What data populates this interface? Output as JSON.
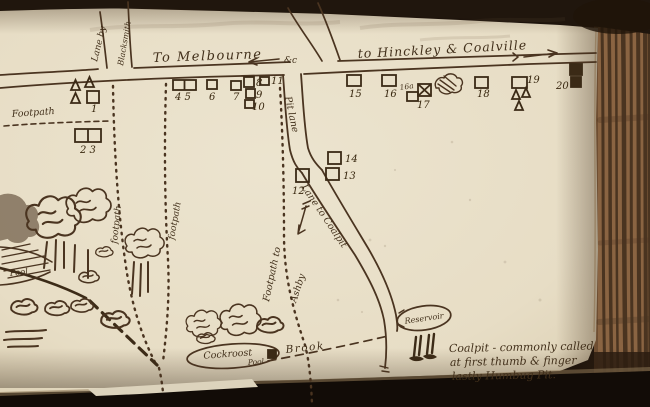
{
  "page": {
    "type": "notebook-hand-drawn-map",
    "paper_color": "#e9e0ca",
    "ink_color": "#4a3420",
    "fore_edge_color": "#8a6442"
  },
  "map": {
    "labels": {
      "to_melbourne": "To Melbourne",
      "etc_mark": "&c",
      "to_hinckley_coalville": "to Hinckley & Coalville",
      "lane_by": "Lane by",
      "blacksmith": "Blacksmith",
      "pit_lane": "Pit lane",
      "lane_to_coalpit": "Lane to Coalpit",
      "footpath_left": "Footpath",
      "footpath_1": "footpath",
      "footpath_2": "footpath",
      "footpath_to": "Footpath to",
      "ashby": "Ashby",
      "brook": "Brook",
      "pool_left": "Pool",
      "cockroost": "Cockroost",
      "cockroost_pool": "Pool",
      "reservoir": "Reservoir",
      "sixteen_a": "16a"
    },
    "note": {
      "line1": "Coalpit - commonly called",
      "line2": "at first thumb & finger",
      "line3": "lastly Humbug Pit."
    },
    "houses": [
      {
        "label": "4 5",
        "kind": "pair",
        "x": 173,
        "y": 80,
        "w": 23,
        "h": 10,
        "lx": 175,
        "ly": 100
      },
      {
        "label": "6",
        "x": 207,
        "y": 80,
        "w": 10,
        "h": 9,
        "lx": 209,
        "ly": 100
      },
      {
        "label": "7",
        "x": 231,
        "y": 81,
        "w": 10,
        "h": 9,
        "lx": 233,
        "ly": 100
      },
      {
        "label": "8",
        "x": 244,
        "y": 77,
        "w": 10,
        "h": 10,
        "lx": 256,
        "ly": 86
      },
      {
        "label": "9",
        "x": 246,
        "y": 89,
        "w": 9,
        "h": 9,
        "lx": 256,
        "ly": 98
      },
      {
        "label": "10",
        "x": 245,
        "y": 100,
        "w": 9,
        "h": 8,
        "lx": 252,
        "ly": 110
      },
      {
        "label": "11",
        "x": 260,
        "y": 77,
        "w": 9,
        "h": 8,
        "lx": 271,
        "ly": 84
      },
      {
        "label": "",
        "name": "hovel-a",
        "kind": "triangle",
        "x": 71,
        "y": 80,
        "w": 9,
        "h": 10
      },
      {
        "label": "",
        "name": "hovel-b",
        "kind": "triangle",
        "x": 85,
        "y": 77,
        "w": 9,
        "h": 10
      },
      {
        "label": "",
        "name": "hovel-c",
        "kind": "triangle",
        "x": 71,
        "y": 93,
        "w": 9,
        "h": 10
      },
      {
        "label": "1",
        "x": 87,
        "y": 91,
        "w": 12,
        "h": 12,
        "lx": 91,
        "ly": 112
      },
      {
        "label": "2 3",
        "kind": "pair",
        "x": 75,
        "y": 129,
        "w": 26,
        "h": 13,
        "lx": 80,
        "ly": 153
      },
      {
        "label": "15",
        "x": 347,
        "y": 75,
        "w": 14,
        "h": 11,
        "lx": 349,
        "ly": 97
      },
      {
        "label": "16",
        "x": 382,
        "y": 75,
        "w": 14,
        "h": 11,
        "lx": 384,
        "ly": 97
      },
      {
        "label": "",
        "name": "house-17-ruin",
        "cross": true,
        "x": 418,
        "y": 84,
        "w": 13,
        "h": 12
      },
      {
        "label": "17",
        "x": 407,
        "y": 92,
        "w": 11,
        "h": 9,
        "lx": 417,
        "ly": 108
      },
      {
        "label": "18",
        "x": 475,
        "y": 77,
        "w": 13,
        "h": 11,
        "lx": 477,
        "ly": 97
      },
      {
        "label": "19",
        "x": 512,
        "y": 77,
        "w": 15,
        "h": 11,
        "lx": 527,
        "ly": 83
      },
      {
        "label": "",
        "name": "hovel-d",
        "kind": "triangle",
        "x": 512,
        "y": 90,
        "w": 8,
        "h": 9
      },
      {
        "label": "",
        "name": "hovel-e",
        "kind": "triangle",
        "x": 522,
        "y": 88,
        "w": 8,
        "h": 9
      },
      {
        "label": "",
        "name": "hovel-f",
        "kind": "triangle",
        "x": 515,
        "y": 101,
        "w": 8,
        "h": 9
      },
      {
        "label": "20",
        "x": 570,
        "y": 64,
        "w": 12,
        "h": 11,
        "filled": true,
        "lx": 556,
        "ly": 89
      },
      {
        "label": "",
        "name": "house-20b",
        "x": 571,
        "y": 77,
        "w": 10,
        "h": 10,
        "filled": true
      },
      {
        "label": "12",
        "x": 296,
        "y": 169,
        "w": 13,
        "h": 13,
        "lx": 292,
        "ly": 194
      },
      {
        "label": "14",
        "x": 328,
        "y": 152,
        "w": 13,
        "h": 12,
        "lx": 345,
        "ly": 162
      },
      {
        "label": "13",
        "x": 326,
        "y": 168,
        "w": 13,
        "h": 12,
        "lx": 343,
        "ly": 179
      }
    ]
  }
}
